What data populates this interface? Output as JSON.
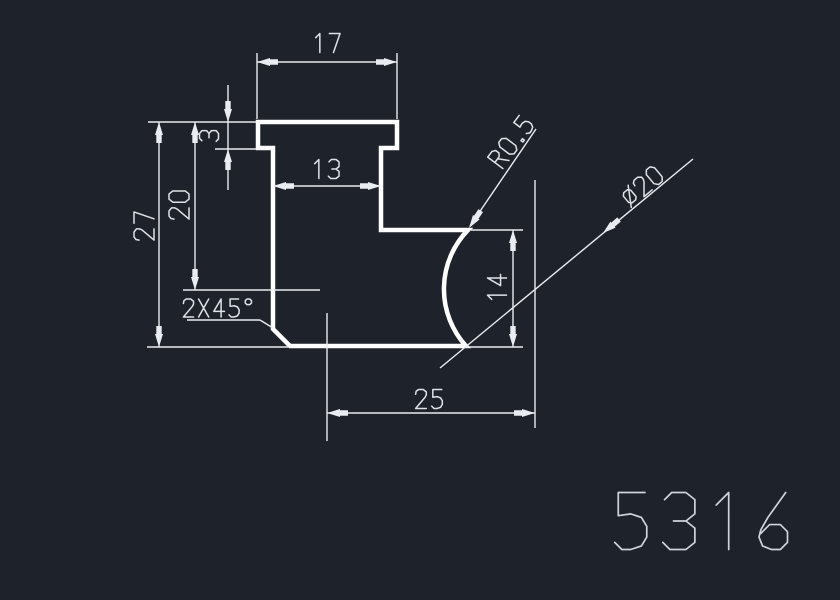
{
  "window": {
    "background": "#1e222b"
  },
  "drawing": {
    "type": "cad-2d-profile-drawing",
    "part_number": "5316",
    "annotations": {
      "dim_top_width": "17",
      "dim_flange_thickness": "3",
      "dim_neck_width": "13",
      "dim_upper_height": "20",
      "dim_total_height": "27",
      "chamfer_note": "2X45°",
      "fillet_radius": "R0.5",
      "circle_diameter": "⌀20",
      "dim_right_height": "14",
      "dim_center_distance": "25"
    },
    "colors": {
      "background": "#1e222b",
      "outline": "#ffffff",
      "dimension": "#e9ecf0",
      "text": "#dfe3e8",
      "part_number": "#cfd4db"
    }
  }
}
